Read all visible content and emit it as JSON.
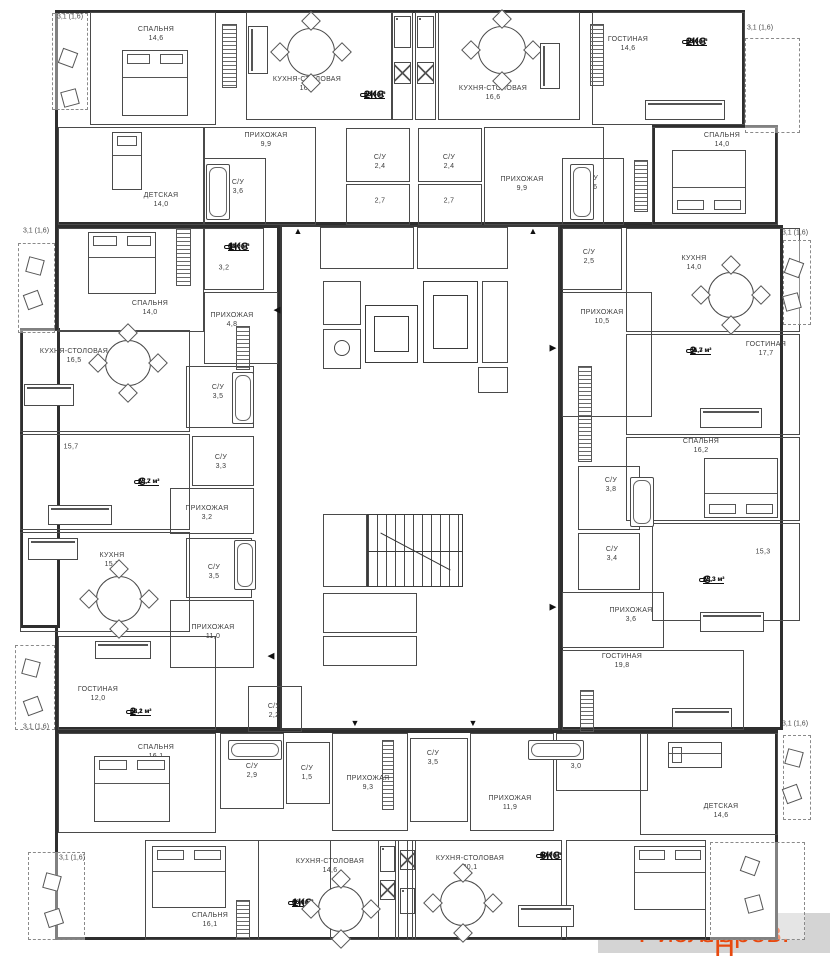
{
  "watermarks": {
    "center": "Avito",
    "corner_prefix": "Риэлторов.",
    "corner_h": "Н",
    "corner_suffix": "ет",
    "corner_color": "#e8490f"
  },
  "floorplan": {
    "blocks": [
      [
        55,
        10,
        690,
        215
      ],
      [
        652,
        125,
        126,
        100
      ],
      [
        55,
        225,
        225,
        505
      ],
      [
        20,
        328,
        40,
        300
      ],
      [
        560,
        225,
        223,
        505
      ],
      [
        55,
        730,
        723,
        210
      ]
    ],
    "core": [
      280,
      225,
      280,
      505
    ],
    "rooms": [
      [
        90,
        12,
        126,
        113
      ],
      [
        246,
        12,
        146,
        108
      ],
      [
        392,
        12,
        21,
        108
      ],
      [
        415,
        12,
        21,
        108
      ],
      [
        438,
        12,
        142,
        108
      ],
      [
        592,
        12,
        153,
        113
      ],
      [
        58,
        127,
        146,
        98
      ],
      [
        204,
        127,
        112,
        98
      ],
      [
        204,
        158,
        62,
        67
      ],
      [
        346,
        128,
        64,
        54
      ],
      [
        346,
        184,
        64,
        41
      ],
      [
        418,
        128,
        64,
        54
      ],
      [
        418,
        184,
        64,
        41
      ],
      [
        484,
        127,
        120,
        98
      ],
      [
        562,
        158,
        62,
        67
      ],
      [
        652,
        127,
        126,
        98
      ],
      [
        58,
        228,
        146,
        104
      ],
      [
        204,
        228,
        60,
        62
      ],
      [
        204,
        292,
        74,
        72
      ],
      [
        186,
        366,
        68,
        62
      ],
      [
        20,
        330,
        170,
        102
      ],
      [
        20,
        434,
        170,
        96
      ],
      [
        192,
        436,
        62,
        50
      ],
      [
        170,
        488,
        84,
        46
      ],
      [
        20,
        532,
        170,
        100
      ],
      [
        186,
        538,
        66,
        60
      ],
      [
        170,
        600,
        84,
        68
      ],
      [
        58,
        636,
        158,
        94
      ],
      [
        248,
        686,
        54,
        46
      ],
      [
        562,
        228,
        60,
        62
      ],
      [
        626,
        228,
        174,
        104
      ],
      [
        562,
        292,
        90,
        125
      ],
      [
        626,
        334,
        174,
        101
      ],
      [
        626,
        437,
        174,
        84
      ],
      [
        578,
        466,
        62,
        64
      ],
      [
        578,
        533,
        62,
        57
      ],
      [
        562,
        592,
        102,
        56
      ],
      [
        652,
        523,
        148,
        98
      ],
      [
        562,
        650,
        182,
        80
      ],
      [
        58,
        733,
        158,
        100
      ],
      [
        220,
        733,
        64,
        76
      ],
      [
        286,
        742,
        44,
        62
      ],
      [
        332,
        733,
        76,
        98
      ],
      [
        410,
        738,
        58,
        84
      ],
      [
        470,
        733,
        84,
        98
      ],
      [
        556,
        733,
        92,
        58
      ],
      [
        640,
        733,
        138,
        102
      ],
      [
        145,
        840,
        186,
        100
      ],
      [
        258,
        840,
        150,
        100
      ],
      [
        378,
        840,
        18,
        100
      ],
      [
        398,
        840,
        18,
        100
      ],
      [
        412,
        840,
        150,
        100
      ],
      [
        566,
        840,
        140,
        100
      ],
      [
        320,
        227,
        94,
        42
      ],
      [
        417,
        227,
        91,
        42
      ],
      [
        323,
        281,
        38,
        44
      ],
      [
        323,
        329,
        38,
        40
      ],
      [
        482,
        281,
        26,
        82
      ],
      [
        478,
        367,
        30,
        26
      ],
      [
        323,
        514,
        44,
        73
      ],
      [
        323,
        593,
        94,
        40
      ],
      [
        323,
        636,
        94,
        30
      ]
    ],
    "hatches": [
      [
        222,
        24,
        15,
        64
      ],
      [
        590,
        24,
        14,
        62
      ],
      [
        176,
        228,
        15,
        58
      ],
      [
        634,
        160,
        14,
        52
      ],
      [
        236,
        326,
        14,
        44
      ],
      [
        578,
        366,
        14,
        96
      ],
      [
        580,
        690,
        14,
        42
      ],
      [
        236,
        900,
        14,
        40
      ],
      [
        382,
        740,
        12,
        70
      ]
    ],
    "balconies": [
      [
        52,
        13,
        36,
        97
      ],
      [
        745,
        38,
        55,
        95
      ],
      [
        18,
        243,
        37,
        90
      ],
      [
        783,
        240,
        28,
        85
      ],
      [
        15,
        645,
        40,
        85
      ],
      [
        783,
        735,
        28,
        85
      ],
      [
        28,
        852,
        57,
        88
      ],
      [
        710,
        842,
        95,
        98
      ]
    ],
    "balcony_labels": [
      {
        "t": "3,1 (1,6)",
        "x": 70,
        "y": 17
      },
      {
        "t": "3,1 (1,6)",
        "x": 760,
        "y": 28
      },
      {
        "t": "3,1 (1,6)",
        "x": 36,
        "y": 231
      },
      {
        "t": "3,1 (1,6)",
        "x": 795,
        "y": 233
      },
      {
        "t": "3,1 (1,6)",
        "x": 36,
        "y": 727
      },
      {
        "t": "3,1 (1,6)",
        "x": 795,
        "y": 724
      },
      {
        "t": "3,1 (1,6)",
        "x": 72,
        "y": 858
      }
    ],
    "labels": [
      {
        "t": "СПАЛЬНЯ",
        "a": "14,6",
        "x": 156,
        "y": 34
      },
      {
        "t": "КУХНЯ-СТОЛОВАЯ",
        "a": "16,6",
        "x": 307,
        "y": 84
      },
      {
        "t": "КУХНЯ-СТОЛОВАЯ",
        "a": "16,6",
        "x": 493,
        "y": 93
      },
      {
        "t": "ГОСТИНАЯ",
        "a": "14,6",
        "x": 628,
        "y": 44
      },
      {
        "t": "ДЕТСКАЯ",
        "a": "14,0",
        "x": 161,
        "y": 200
      },
      {
        "t": "С/У",
        "a": "3,6",
        "x": 238,
        "y": 187
      },
      {
        "t": "ПРИХОЖАЯ",
        "a": "9,9",
        "x": 266,
        "y": 140
      },
      {
        "t": "С/У",
        "a": "2,4",
        "x": 380,
        "y": 162
      },
      {
        "t": "",
        "a": "2,7",
        "x": 380,
        "y": 201
      },
      {
        "t": "С/У",
        "a": "2,4",
        "x": 449,
        "y": 162
      },
      {
        "t": "",
        "a": "2,7",
        "x": 449,
        "y": 201
      },
      {
        "t": "ПРИХОЖАЯ",
        "a": "9,9",
        "x": 522,
        "y": 184
      },
      {
        "t": "С/У",
        "a": "3,6",
        "x": 592,
        "y": 183
      },
      {
        "t": "СПАЛЬНЯ",
        "a": "14,0",
        "x": 722,
        "y": 140
      },
      {
        "t": "СПАЛЬНЯ",
        "a": "14,0",
        "x": 150,
        "y": 308
      },
      {
        "t": "",
        "a": "3,2",
        "x": 224,
        "y": 268
      },
      {
        "t": "ПРИХОЖАЯ",
        "a": "4,8",
        "x": 232,
        "y": 320
      },
      {
        "t": "С/У",
        "a": "3,5",
        "x": 218,
        "y": 392
      },
      {
        "t": "КУХНЯ-СТОЛОВАЯ",
        "a": "16,5",
        "x": 74,
        "y": 356
      },
      {
        "t": "",
        "a": "15,7",
        "x": 71,
        "y": 447
      },
      {
        "t": "С/У",
        "a": "3,3",
        "x": 221,
        "y": 462
      },
      {
        "t": "ПРИХОЖАЯ",
        "a": "3,2",
        "x": 207,
        "y": 513
      },
      {
        "t": "КУХНЯ",
        "a": "15,7",
        "x": 112,
        "y": 560
      },
      {
        "t": "С/У",
        "a": "3,5",
        "x": 214,
        "y": 572
      },
      {
        "t": "ПРИХОЖАЯ",
        "a": "11,0",
        "x": 213,
        "y": 632
      },
      {
        "t": "ГОСТИНАЯ",
        "a": "12,0",
        "x": 98,
        "y": 694
      },
      {
        "t": "СПАЛЬНЯ",
        "a": "16,1",
        "x": 156,
        "y": 752
      },
      {
        "t": "С/У",
        "a": "2,2",
        "x": 274,
        "y": 711
      },
      {
        "t": "С/У",
        "a": "2,9",
        "x": 252,
        "y": 771
      },
      {
        "t": "С/У",
        "a": "1,5",
        "x": 307,
        "y": 773
      },
      {
        "t": "ПРИХОЖАЯ",
        "a": "9,3",
        "x": 368,
        "y": 783
      },
      {
        "t": "С/У",
        "a": "3,5",
        "x": 433,
        "y": 758
      },
      {
        "t": "ПРИХОЖАЯ",
        "a": "11,9",
        "x": 510,
        "y": 803
      },
      {
        "t": "С/У",
        "a": "3,0",
        "x": 576,
        "y": 762
      },
      {
        "t": "СПАЛЬНЯ",
        "a": "16,1",
        "x": 210,
        "y": 920
      },
      {
        "t": "КУХНЯ-СТОЛОВАЯ",
        "a": "14,6",
        "x": 330,
        "y": 866
      },
      {
        "t": "КУХНЯ-СТОЛОВАЯ",
        "a": "20,1",
        "x": 470,
        "y": 863
      },
      {
        "t": "ДЕТСКАЯ",
        "a": "14,6",
        "x": 721,
        "y": 811
      },
      {
        "t": "С/У",
        "a": "2,5",
        "x": 589,
        "y": 257
      },
      {
        "t": "КУХНЯ",
        "a": "14,0",
        "x": 694,
        "y": 263
      },
      {
        "t": "ПРИХОЖАЯ",
        "a": "10,5",
        "x": 602,
        "y": 317
      },
      {
        "t": "ГОСТИНАЯ",
        "a": "17,7",
        "x": 766,
        "y": 349
      },
      {
        "t": "СПАЛЬНЯ",
        "a": "16,2",
        "x": 701,
        "y": 446
      },
      {
        "t": "С/У",
        "a": "3,8",
        "x": 611,
        "y": 485
      },
      {
        "t": "С/У",
        "a": "3,4",
        "x": 612,
        "y": 554
      },
      {
        "t": "ПРИХОЖАЯ",
        "a": "3,6",
        "x": 631,
        "y": 615
      },
      {
        "t": "",
        "a": "15,3",
        "x": 763,
        "y": 552
      },
      {
        "t": "ГОСТИНАЯ",
        "a": "19,8",
        "x": 622,
        "y": 661
      }
    ],
    "badges": [
      {
        "k": "2КС",
        "a": "65,4 м²",
        "b": "28,6 м²",
        "x": 364,
        "y": 95
      },
      {
        "k": "2КС",
        "a": "65,4 м²",
        "b": "28,6 м²",
        "x": 686,
        "y": 42
      },
      {
        "k": "1КС",
        "a": "43,6 м²",
        "b": "14,0 м²",
        "x": 228,
        "y": 247
      },
      {
        "k": "2",
        "a": "66,3 м²",
        "b": "31,7 м²",
        "x": 690,
        "y": 351
      },
      {
        "k": "С",
        "a": "22,2 м²",
        "b": "15,7 м²",
        "x": 138,
        "y": 482
      },
      {
        "k": "С",
        "a": "22,3 м²",
        "b": "15,3 м²",
        "x": 703,
        "y": 580
      },
      {
        "k": "2",
        "a": "62,2 м²",
        "b": "28,1 м²",
        "x": 130,
        "y": 712
      },
      {
        "k": "1КС",
        "a": "46,0 м²",
        "b": "16,1 м²",
        "x": 292,
        "y": 903
      },
      {
        "k": "3КС",
        "a": "90,7 м²",
        "b": "49,0 м²",
        "x": 540,
        "y": 856
      }
    ],
    "arrows": [
      {
        "g": "▲",
        "x": 298,
        "y": 231
      },
      {
        "g": "▲",
        "x": 533,
        "y": 231
      },
      {
        "g": "◀",
        "x": 277,
        "y": 310
      },
      {
        "g": "▶",
        "x": 553,
        "y": 348
      },
      {
        "g": "◀",
        "x": 271,
        "y": 656
      },
      {
        "g": "▶",
        "x": 553,
        "y": 607
      },
      {
        "g": "▼",
        "x": 355,
        "y": 723
      },
      {
        "g": "▼",
        "x": 473,
        "y": 723
      }
    ],
    "beds": [
      {
        "x": 122,
        "y": 50,
        "w": 66,
        "h": 66,
        "p": "t",
        "s": 2
      },
      {
        "x": 672,
        "y": 150,
        "w": 74,
        "h": 64,
        "p": "b",
        "s": 2
      },
      {
        "x": 88,
        "y": 232,
        "w": 68,
        "h": 62,
        "p": "t",
        "s": 2
      },
      {
        "x": 704,
        "y": 458,
        "w": 74,
        "h": 60,
        "p": "b",
        "s": 2
      },
      {
        "x": 94,
        "y": 756,
        "w": 76,
        "h": 66,
        "p": "t",
        "s": 2
      },
      {
        "x": 152,
        "y": 846,
        "w": 74,
        "h": 62,
        "p": "t",
        "s": 2
      },
      {
        "x": 634,
        "y": 846,
        "w": 72,
        "h": 64,
        "p": "t",
        "s": 2
      },
      {
        "x": 112,
        "y": 132,
        "w": 30,
        "h": 58,
        "p": "t",
        "s": 1
      },
      {
        "x": 668,
        "y": 742,
        "w": 54,
        "h": 26,
        "p": "l",
        "s": 1
      }
    ],
    "tables": [
      [
        287,
        28,
        48
      ],
      [
        478,
        26,
        48
      ],
      [
        105,
        340,
        46
      ],
      [
        96,
        576,
        46
      ],
      [
        708,
        272,
        46
      ],
      [
        318,
        886,
        46
      ],
      [
        440,
        880,
        46
      ]
    ],
    "sofas": [
      {
        "x": 248,
        "y": 26,
        "w": 20,
        "h": 48,
        "o": "v"
      },
      {
        "x": 540,
        "y": 43,
        "w": 20,
        "h": 46,
        "o": "v"
      },
      {
        "x": 645,
        "y": 100,
        "w": 80,
        "h": 20,
        "o": "h"
      },
      {
        "x": 24,
        "y": 384,
        "w": 50,
        "h": 22,
        "o": "h"
      },
      {
        "x": 48,
        "y": 505,
        "w": 64,
        "h": 20,
        "o": "h"
      },
      {
        "x": 28,
        "y": 538,
        "w": 50,
        "h": 22,
        "o": "h"
      },
      {
        "x": 95,
        "y": 641,
        "w": 56,
        "h": 18,
        "o": "h"
      },
      {
        "x": 700,
        "y": 408,
        "w": 62,
        "h": 20,
        "o": "h"
      },
      {
        "x": 700,
        "y": 612,
        "w": 64,
        "h": 20,
        "o": "h"
      },
      {
        "x": 672,
        "y": 708,
        "w": 60,
        "h": 20,
        "o": "h"
      },
      {
        "x": 518,
        "y": 905,
        "w": 56,
        "h": 22,
        "o": "h"
      }
    ],
    "baths": [
      [
        206,
        164,
        24,
        56
      ],
      [
        570,
        164,
        24,
        56
      ],
      [
        232,
        372,
        22,
        52
      ],
      [
        234,
        540,
        22,
        50
      ],
      [
        630,
        477,
        24,
        50
      ],
      [
        228,
        740,
        54,
        20
      ],
      [
        528,
        740,
        56,
        20
      ]
    ],
    "stoves": [
      [
        394,
        16,
        17,
        32
      ],
      [
        417,
        16,
        17,
        32
      ],
      [
        380,
        846,
        15,
        26
      ],
      [
        400,
        888,
        15,
        26
      ]
    ],
    "sinks": [
      [
        394,
        62,
        17,
        22
      ],
      [
        417,
        62,
        17,
        22
      ],
      [
        380,
        880,
        15,
        20
      ],
      [
        400,
        850,
        15,
        20
      ]
    ],
    "chairs": [
      [
        60,
        50,
        20
      ],
      [
        62,
        90,
        -15
      ],
      [
        27,
        258,
        15
      ],
      [
        25,
        292,
        -20
      ],
      [
        786,
        260,
        20
      ],
      [
        784,
        294,
        -15
      ],
      [
        23,
        660,
        15
      ],
      [
        25,
        698,
        -20
      ],
      [
        786,
        750,
        15
      ],
      [
        784,
        786,
        -20
      ],
      [
        44,
        874,
        15
      ],
      [
        46,
        910,
        -18
      ],
      [
        742,
        858,
        20
      ],
      [
        746,
        896,
        -15
      ]
    ],
    "elevators": [
      {
        "o": [
          365,
          305,
          53,
          58
        ],
        "i": [
          374,
          316,
          35,
          36
        ]
      },
      {
        "o": [
          423,
          281,
          55,
          82
        ],
        "i": [
          433,
          295,
          35,
          54
        ]
      }
    ],
    "stairs": [
      367,
      514,
      96,
      73
    ],
    "chute": [
      334,
      340,
      16,
      16
    ]
  }
}
